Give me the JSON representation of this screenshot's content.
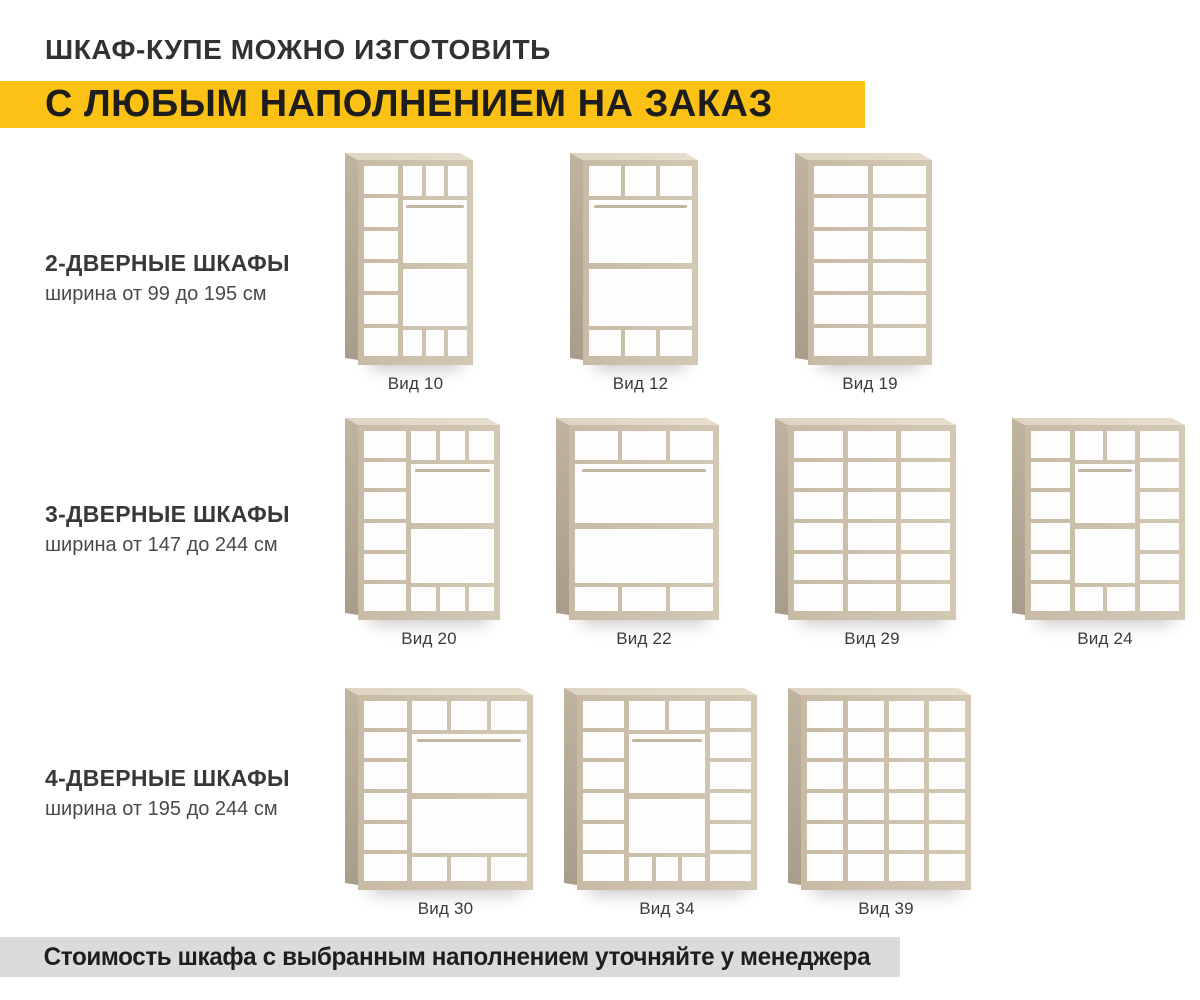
{
  "header": {
    "title": "ШКАФ-КУПЕ МОЖНО ИЗГОТОВИТЬ",
    "subtitle": "С ЛЮБЫМ НАПОЛНЕНИЕМ НА ЗАКАЗ"
  },
  "colors": {
    "accent_yellow": "#FCC115",
    "footer_gray": "#DBDBDB",
    "wood": "#CDC1AD",
    "wood_dark": "#AD A18F",
    "text_dark": "#333333"
  },
  "rows": [
    {
      "title": "2-ДВЕРНЫЕ ШКАФЫ",
      "subtitle": "ширина от 99 до 195 см",
      "items": [
        {
          "label": "Вид 10",
          "width": 115,
          "height": 205,
          "cols": [
            {
              "type": "shelves",
              "flex": 1,
              "rows": 6
            },
            {
              "type": "hang",
              "flex": 1.9,
              "top": 3,
              "bottom": 3
            }
          ]
        },
        {
          "label": "Вид 12",
          "width": 115,
          "height": 205,
          "cols": [
            {
              "type": "hang",
              "flex": 1,
              "top": 3,
              "bottom": 3
            }
          ]
        },
        {
          "label": "Вид 19",
          "width": 124,
          "height": 205,
          "cols": [
            {
              "type": "shelves",
              "flex": 1,
              "rows": 6
            },
            {
              "type": "shelves",
              "flex": 1,
              "rows": 6
            }
          ]
        }
      ]
    },
    {
      "title": "3-ДВЕРНЫЕ ШКАФЫ",
      "subtitle": "ширина от 147 до 244 см",
      "items": [
        {
          "label": "Вид 20",
          "width": 142,
          "height": 195,
          "cols": [
            {
              "type": "shelves",
              "flex": 1,
              "rows": 6
            },
            {
              "type": "hang",
              "flex": 2,
              "top": 3,
              "bottom": 3
            }
          ]
        },
        {
          "label": "Вид 22",
          "width": 150,
          "height": 195,
          "cols": [
            {
              "type": "hang",
              "flex": 1,
              "top": 3,
              "bottom": 3
            }
          ]
        },
        {
          "label": "Вид 29",
          "width": 168,
          "height": 195,
          "cols": [
            {
              "type": "shelves",
              "flex": 1,
              "rows": 6
            },
            {
              "type": "shelves",
              "flex": 1,
              "rows": 6
            },
            {
              "type": "shelves",
              "flex": 1,
              "rows": 6
            }
          ]
        },
        {
          "label": "Вид 24",
          "width": 160,
          "height": 195,
          "cols": [
            {
              "type": "shelves",
              "flex": 1,
              "rows": 6
            },
            {
              "type": "hang",
              "flex": 1.5,
              "top": 2,
              "bottom": 2
            },
            {
              "type": "shelves",
              "flex": 1,
              "rows": 6
            }
          ]
        }
      ]
    },
    {
      "title": "4-ДВЕРНЫЕ ШКАФЫ",
      "subtitle": "ширина от 195 до 244 см",
      "items": [
        {
          "label": "Вид 30",
          "width": 175,
          "height": 195,
          "cols": [
            {
              "type": "shelves",
              "flex": 1,
              "rows": 6
            },
            {
              "type": "hang",
              "flex": 2.7,
              "top": 3,
              "bottom": 3
            }
          ]
        },
        {
          "label": "Вид 34",
          "width": 180,
          "height": 195,
          "cols": [
            {
              "type": "shelves",
              "flex": 1,
              "rows": 6
            },
            {
              "type": "hang",
              "flex": 1.9,
              "top": 2,
              "bottom": 3
            },
            {
              "type": "shelves",
              "flex": 1,
              "rows": 6
            }
          ]
        },
        {
          "label": "Вид 39",
          "width": 170,
          "height": 195,
          "cols": [
            {
              "type": "shelves",
              "flex": 1,
              "rows": 6
            },
            {
              "type": "shelves",
              "flex": 1,
              "rows": 6
            },
            {
              "type": "shelves",
              "flex": 1,
              "rows": 6
            },
            {
              "type": "shelves",
              "flex": 1,
              "rows": 6
            }
          ]
        }
      ]
    }
  ],
  "footer": {
    "note": "Стоимость шкафа с выбранным наполнением уточняйте у менеджера"
  }
}
